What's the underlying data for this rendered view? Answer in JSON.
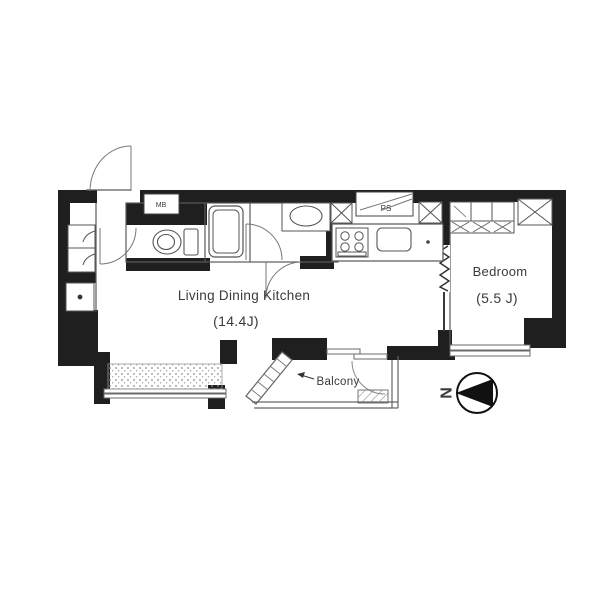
{
  "plan": {
    "rooms": {
      "ldk": {
        "label": "Living Dining Kitchen",
        "size": "(14.4J)"
      },
      "bedroom": {
        "label": "Bedroom",
        "size": "(5.5 J)"
      },
      "balcony": {
        "label": "Balcony"
      }
    },
    "service_labels": {
      "meter_box": "MB",
      "pipe_space": "PS"
    },
    "compass": {
      "north_label": "N"
    },
    "fixtures": [
      "entrance-door",
      "hall-door",
      "hall-cabinet",
      "water-heater",
      "toilet",
      "bathtub",
      "bath-door",
      "washbasin",
      "washroom-door",
      "stove",
      "kitchen-sink",
      "pipe-space-box",
      "closet",
      "sliding-door",
      "accordion-door",
      "balcony-window",
      "planter-strip",
      "drain-pan"
    ],
    "colors": {
      "wall": "#1f1f1f",
      "line": "#5a5a5a",
      "background": "#ffffff",
      "text": "#3a3a3a"
    }
  }
}
